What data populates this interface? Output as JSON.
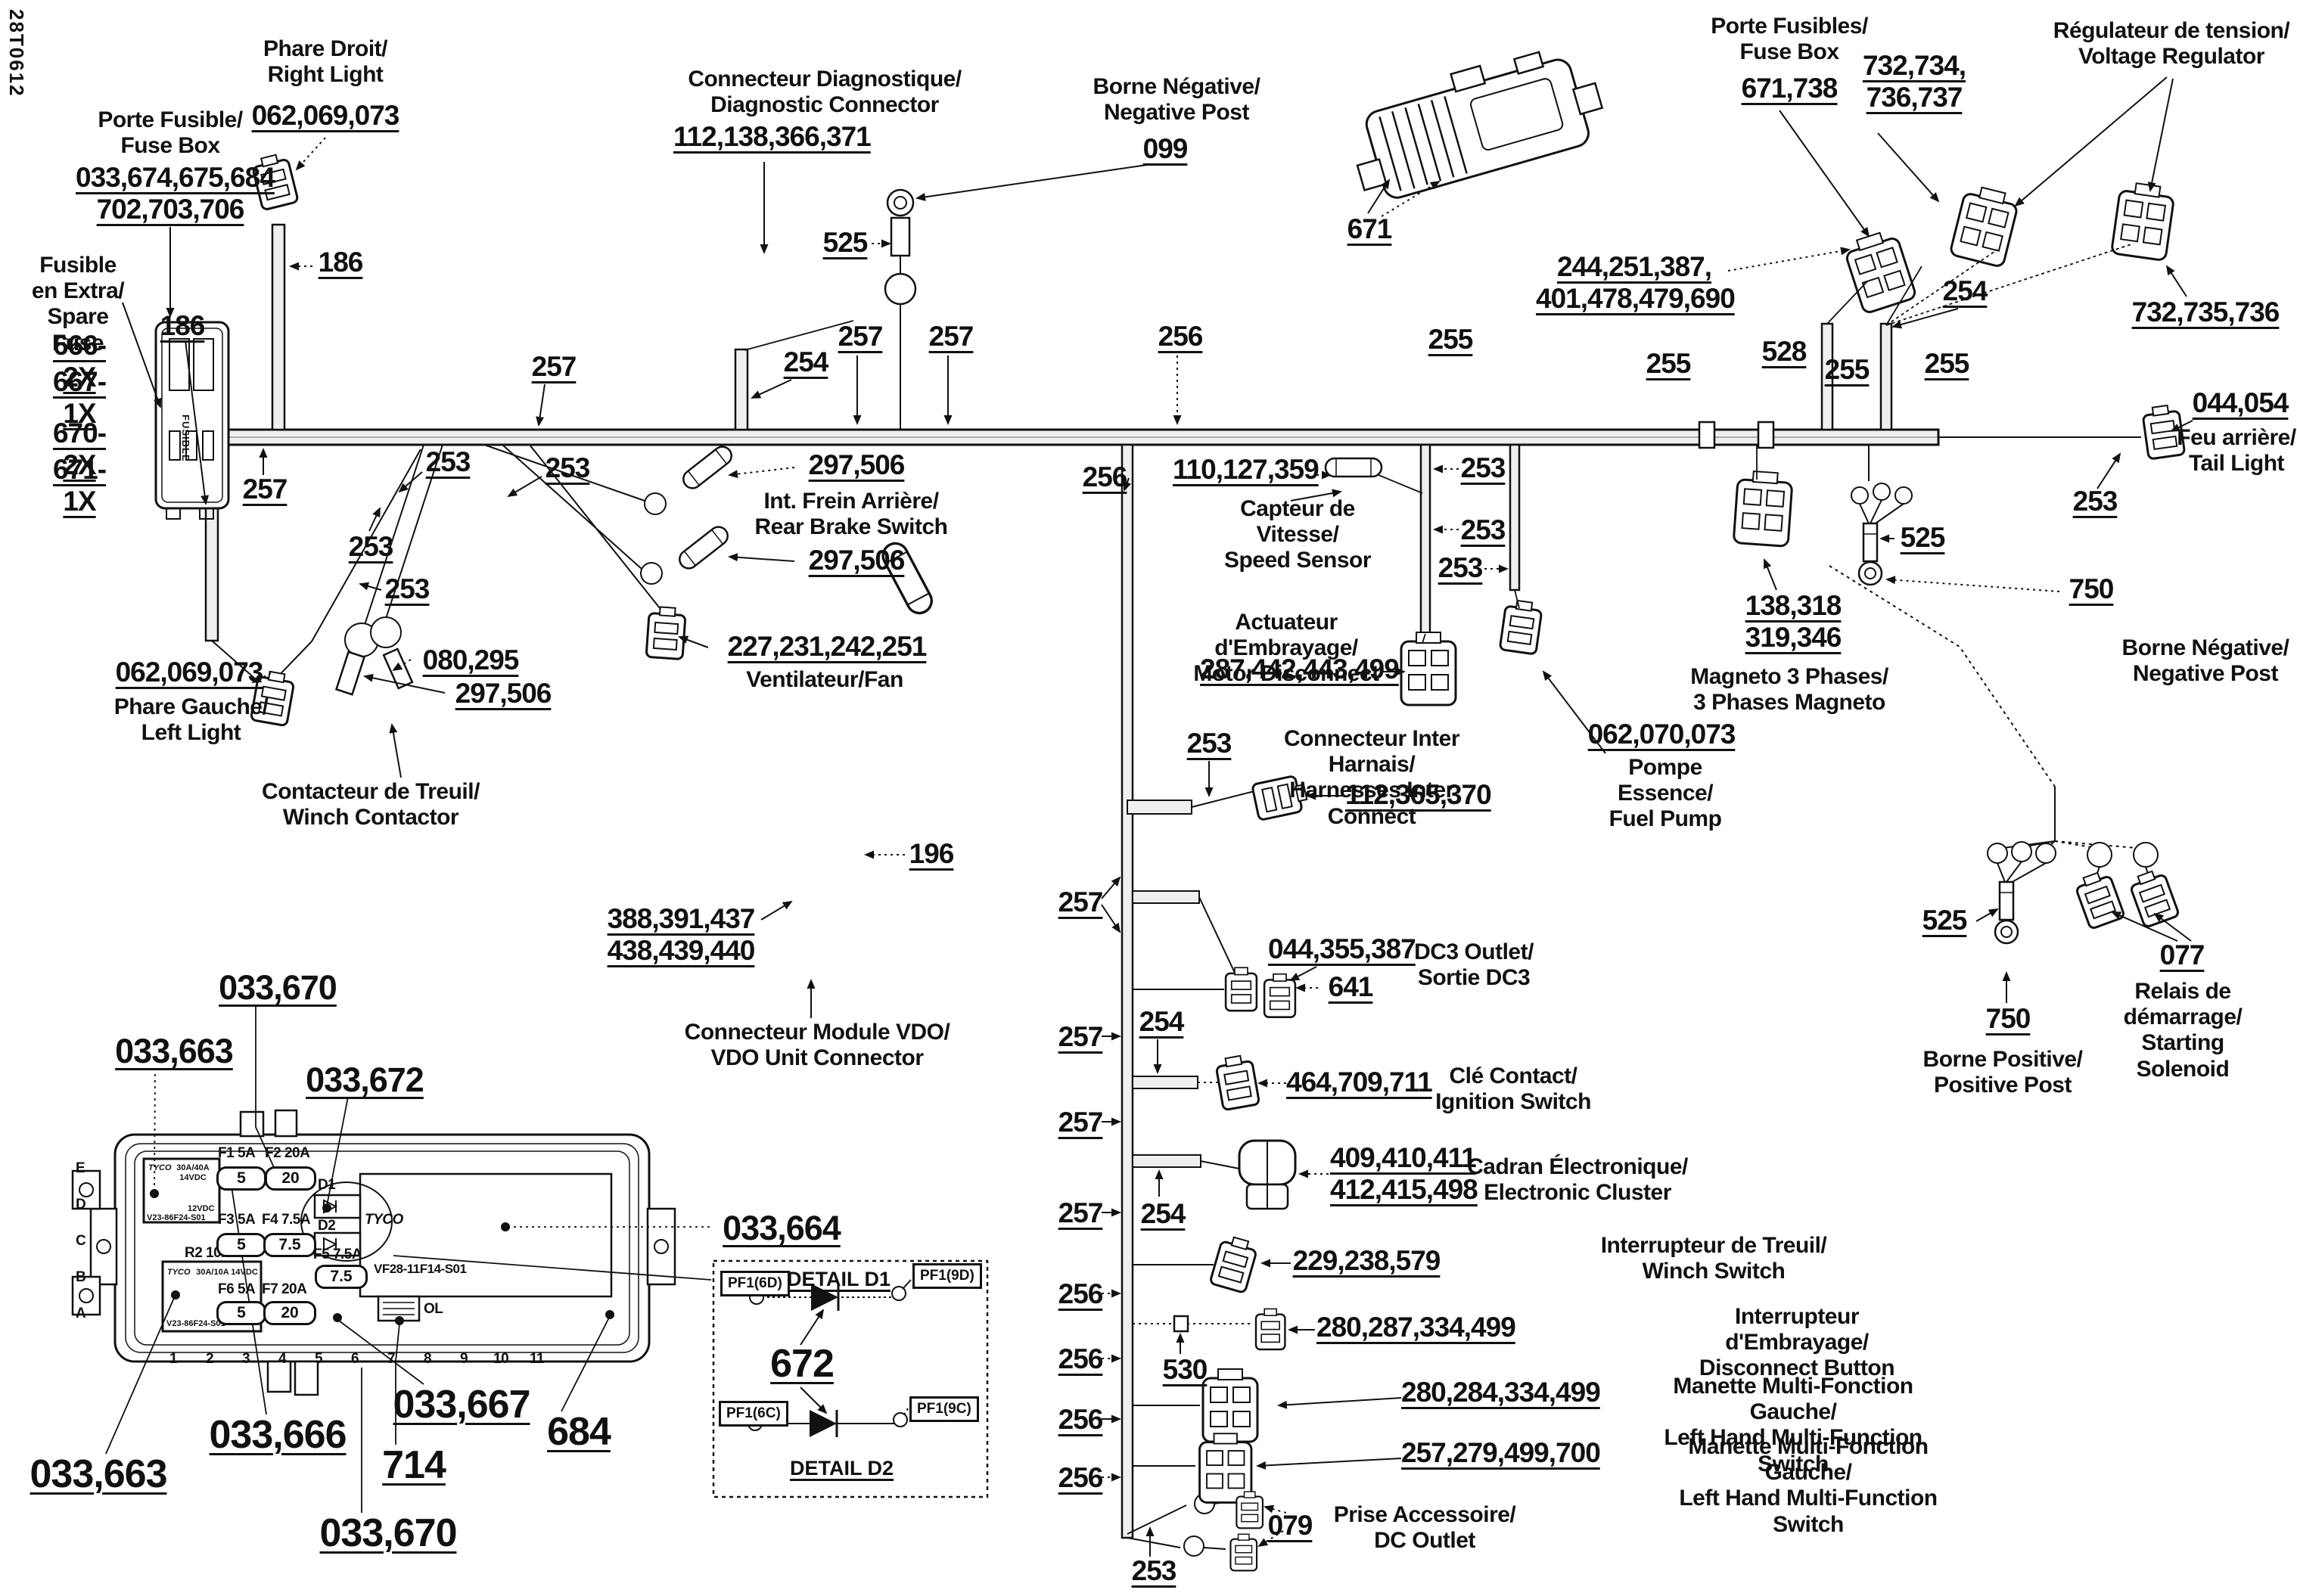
{
  "doc_code": "28T0612",
  "labels": {
    "right_light_name": "Phare Droit/\nRight Light",
    "right_light_num": "062,069,073",
    "fuse_holder_name": "Porte Fusible/\nFuse Box",
    "fuse_holder_num": "033,674,675,684\n702,703,706",
    "fuse_holder_body": "FUSIBLE",
    "spare_fuse_name": "Fusible\nen Extra/\nSpare Fuse",
    "spare1": "666-2X",
    "spare2": "667-1X",
    "spare3": "670-2X",
    "spare4": "671-1X",
    "w186a": "186",
    "w186b": "186",
    "n257a": "257",
    "diag_name": "Connecteur Diagnostique/\nDiagnostic Connector",
    "diag_num": "112,138,366,371",
    "n254a": "254",
    "n257b": "257",
    "neg_post_name": "Borne Négative/\nNegative Post",
    "neg_post_num": "099",
    "n525a": "525",
    "n257c": "257",
    "n257d": "257",
    "n256a": "256",
    "n256b": "256",
    "n253a": "253",
    "n253b": "253",
    "n253c": "253",
    "n253d": "253",
    "rear_brake_num1": "297,506",
    "rear_brake_name": "Int. Frein Arrière/\nRear Brake Switch",
    "rear_brake_num2": "297,506",
    "fan_num": "227,231,242,251",
    "fan_name": "Ventilateur/Fan",
    "winch_cont_num1": "080,295",
    "winch_cont_num2": "297,506",
    "winch_cont_name": "Contacteur de Treuil/\nWinch Contactor",
    "left_light_num": "062,069,073",
    "left_light_name": "Phare Gauche/\nLeft Light",
    "vdo_num": "388,391,437\n438,439,440",
    "vdo_name": "Connecteur Module VDO/\nVDO Unit Connector",
    "n196": "196",
    "fusebox671_name": "Porte Fusibles/\nFuse Box",
    "fusebox671_num": "671,738",
    "n671": "671",
    "vr_nums1": "732,734,\n736,737",
    "vr_name": "Régulateur de tension/\nVoltage Regulator",
    "vr_nums2": "732,735,736",
    "harness_nums": "244,251,387,\n401,478,479,690",
    "n254b": "254",
    "n255a": "255",
    "n255b": "255",
    "n255c": "255",
    "n255d": "255",
    "n528": "528",
    "tail_num": "044,054",
    "tail_name": "Feu arrière/\nTail Light",
    "n253e": "253",
    "n525b": "525",
    "n750a": "750",
    "neg_post2_name": "Borne Négative/\nNegative Post",
    "magneto_num": "138,318\n319,346",
    "magneto_name": "Magneto 3 Phases/\n3 Phases Magneto",
    "speed_num": "110,127,359",
    "speed_name": "Capteur de\nVitesse/\nSpeed Sensor",
    "n253f": "253",
    "n253g": "253",
    "n253h": "253",
    "motor_name": "Actuateur d'Embrayage/\nMotor Disconnect",
    "motor_num": "287,442,443,499",
    "fuel_num": "062,070,073",
    "fuel_name": "Pompe Essence/\nFuel Pump",
    "n253i": "253",
    "inter_name": "Connecteur Inter Harnais/\nHarnesses Inter Connect",
    "inter_num": "112,365,370",
    "n525c": "525",
    "n077": "077",
    "solenoid_name": "Relais de\ndémarrage/\nStarting\nSolenoid",
    "n750b": "750",
    "pos_post_name": "Borne Positive/\nPositive Post",
    "tree257_1": "257",
    "tree257_2": "257",
    "tree257_3": "257",
    "tree257_4": "257",
    "tree256_1": "256",
    "tree256_2": "256",
    "tree256_3": "256",
    "tree256_4": "256",
    "dc3_num": "044,355,387",
    "dc3_num2": "641",
    "dc3_name": "DC3 Outlet/\nSortie DC3",
    "n254c": "254",
    "ign_num": "464,709,711",
    "ign_name": "Clé Contact/\nIgnition Switch",
    "cluster_num": "409,410,411\n412,415,498",
    "cluster_name": "Cadran Électronique/\nElectronic Cluster",
    "n254d": "254",
    "winchsw_num": "229,238,579",
    "winchsw_name": "Interrupteur de Treuil/\nWinch Switch",
    "discon_num": "280,287,334,499",
    "discon_name": "Interrupteur d'Embrayage/\nDisconnect Button",
    "n530": "530",
    "mf1_num": "280,284,334,499",
    "mf1_name": "Manette Multi-Fonction Gauche/\nLeft Hand Multi-Function Switch",
    "mf2_num": "257,279,499,700",
    "mf2_name": "Manette Multi-Fonction Gauche/\nLeft Hand Multi-Function Switch",
    "dcout_num": "079",
    "dcout_name": "Prise Accessoire/\nDC Outlet",
    "n253j": "253",
    "fb670a": "033,670",
    "fb663a": "033,663",
    "fb672": "033,672",
    "fb664": "033,664",
    "fb663b": "033,663",
    "fb666": "033,666",
    "fb714": "714",
    "fb667": "033,667",
    "fb684": "684",
    "fb670b": "033,670"
  },
  "fusebox": {
    "relay1": {
      "brand": "TYCO",
      "rating": "30A/40A 14VDC",
      "voltage": "12VDC",
      "part": "V23-86F24-S01"
    },
    "relay2": {
      "slot": "R2 10A",
      "brand": "TYCO",
      "rating": "30A/10A 14VDC",
      "voltage": "12VDC",
      "part": "V23-86F24-S01"
    },
    "fuses": [
      {
        "label": "F1 5A",
        "value": "5"
      },
      {
        "label": "F2 20A",
        "value": "20"
      },
      {
        "label": "F3 5A",
        "value": "5"
      },
      {
        "label": "F4 7.5A",
        "value": "7.5"
      },
      {
        "label": "F5 7.5A",
        "value": "7.5"
      },
      {
        "label": "F6 5A",
        "value": "5"
      },
      {
        "label": "F7 20A",
        "value": "20"
      }
    ],
    "diodes": [
      "D1",
      "D2"
    ],
    "panel_part": "VF28-11F14-S01",
    "ol": "OL",
    "tyco": "TYCO",
    "letters": [
      "E",
      "D",
      "C",
      "B",
      "A"
    ],
    "pins": [
      "1",
      "2",
      "3",
      "4",
      "5",
      "6",
      "7",
      "8",
      "9",
      "10",
      "11"
    ]
  },
  "detail_box": {
    "title_d1": "DETAIL D1",
    "title_d2": "DETAIL D2",
    "ref": "672",
    "pf_6d": "PF1(6D)",
    "pf_9d": "PF1(9D)",
    "pf_6c": "PF1(6C)",
    "pf_9c": "PF1(9C)"
  }
}
